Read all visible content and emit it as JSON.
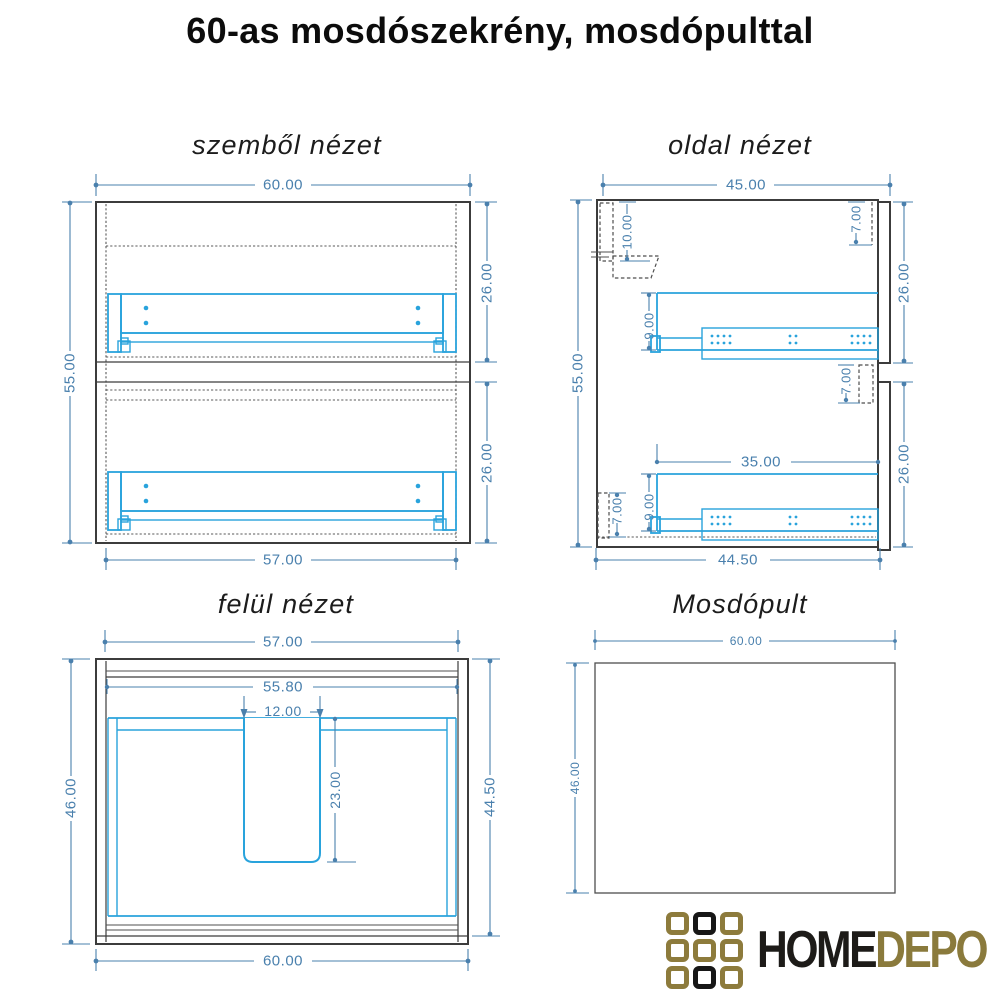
{
  "page": {
    "title": "60-as mosdószekrény, mosdópulttal",
    "background": "#ffffff"
  },
  "colors": {
    "drawing_outline": "#3c3c3c",
    "drawing_cyan": "#29a3dc",
    "dimension_blue": "#4a80ad",
    "logo_gold": "#8a7a3c",
    "logo_black": "#1d1b18"
  },
  "views": {
    "front": {
      "title": "szemből nézet",
      "dims": {
        "width_top": "60.00",
        "height_left": "55.00",
        "upper_section_right": "26.00",
        "lower_section_right": "26.00",
        "width_bottom": "57.00"
      }
    },
    "side": {
      "title": "oldal nézet",
      "dims": {
        "depth_top": "45.00",
        "hanger_offset": "10.00",
        "top_rail_depth": "7.00",
        "height_left": "55.00",
        "upper_section_right": "26.00",
        "divider_gap": "7.00",
        "upper_drawer_height": "9.00",
        "slide_length": "35.00",
        "lower_drawer_height": "9.00",
        "plinth_height": "7.00",
        "lower_section_right": "26.00",
        "depth_bottom": "44.50"
      }
    },
    "top": {
      "title": "felül nézet",
      "dims": {
        "inner_width_top": "57.00",
        "back_panel_width": "55.80",
        "cutout_width": "12.00",
        "cutout_depth": "23.00",
        "depth_left": "46.00",
        "body_depth_right": "44.50",
        "width_bottom": "60.00"
      }
    },
    "counter": {
      "title": "Mosdópult",
      "dims": {
        "width_top": "60.00",
        "depth_left": "46.00"
      }
    }
  },
  "logo": {
    "word_home": "HOME",
    "word_depo": "DEPO",
    "grid_pattern": [
      [
        "gold",
        "black",
        "gold"
      ],
      [
        "gold",
        "gold",
        "gold"
      ],
      [
        "gold",
        "black",
        "gold"
      ]
    ]
  }
}
